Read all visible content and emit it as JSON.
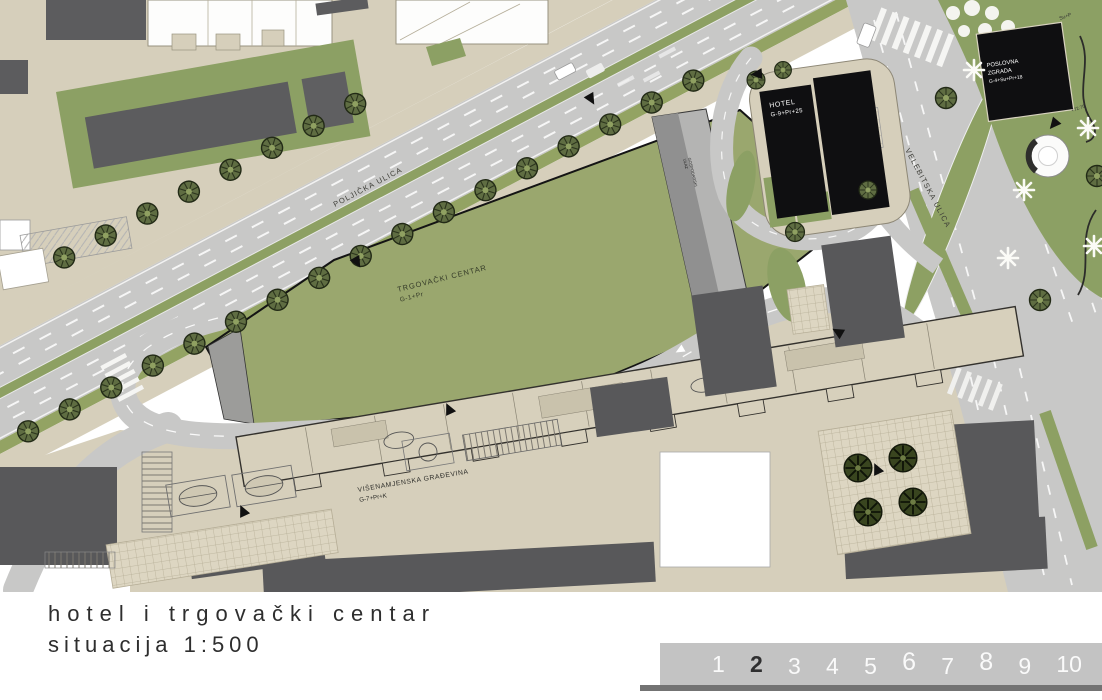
{
  "title": {
    "line1": "hotel i trgovački centar",
    "line2": "situacija 1:500"
  },
  "pagination": {
    "pages": [
      "1",
      "2",
      "3",
      "4",
      "5",
      "6",
      "7",
      "8",
      "9",
      "10"
    ],
    "active_page": "2"
  },
  "plan": {
    "streets": {
      "poljicka": "POLJIČKA ULICA",
      "velebitska": "VELEBITSKA ULICA"
    },
    "buildings": {
      "shopping_center": {
        "name": "TRGOVAČKI CENTAR",
        "floors": "G-1+Pr"
      },
      "hotel": {
        "name": "HOTEL",
        "floors": "G-9+Pr+25"
      },
      "office": {
        "name_line1": "POSLOVNA",
        "name_line2": "ZGRADA",
        "floors": "G-4+Su+Pr+18"
      },
      "multipurpose": {
        "name": "VIŠENAMJENSKA GRAĐEVINA",
        "floors": "G-7+Pr+K"
      }
    },
    "annotations": {
      "ramp_line1": "GOSPODARSKI",
      "ramp_line2": "ULAZ",
      "zone": "Su+P",
      "elevation": "+72.75"
    },
    "colors": {
      "roof_green": "#9aa76e",
      "park_green": "#8ca064",
      "road_gray": "#c8c8c7",
      "ground_beige": "#d6cfbb",
      "building_dark": "#5c5c5e",
      "building_black": "#0f0f11",
      "bar_gray": "#c3c3c3"
    }
  }
}
